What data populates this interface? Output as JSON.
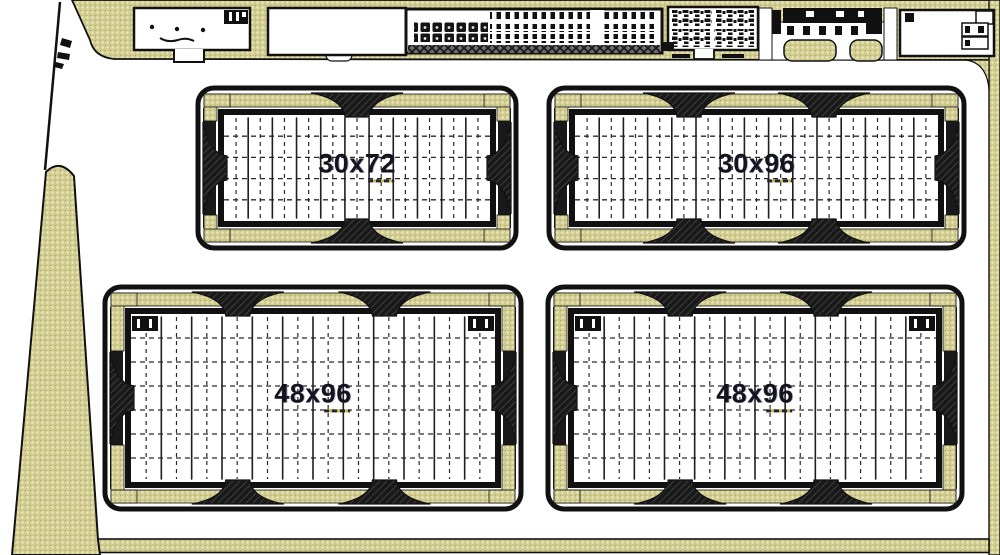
{
  "drawing": {
    "kind": "site-plan",
    "colors": {
      "landscape_khaki": "#cfcb8e",
      "landscape_dot_light": "#eee9bf",
      "landscape_dot_dark": "#a39f66",
      "ink": "#111111",
      "grid_solid": "#1f1f1f",
      "grid_dash": "#2a2a2a",
      "label_text": "#14141f",
      "vent_dark": "#191919",
      "hatch_gray": "#6b6b6b"
    }
  },
  "greenhouses": [
    {
      "label": "30x72",
      "x": 198,
      "y": 88,
      "w": 318,
      "h": 160,
      "cols": 11,
      "rows": 5,
      "vents": [
        0.5
      ],
      "corner_boxes": false
    },
    {
      "label": "30x96",
      "x": 549,
      "y": 88,
      "w": 415,
      "h": 160,
      "cols": 15,
      "rows": 5,
      "vents": [
        0.32,
        0.68
      ],
      "corner_boxes": false
    },
    {
      "label": "48x96",
      "x": 105,
      "y": 287,
      "w": 416,
      "h": 222,
      "cols": 12,
      "rows": 7,
      "vents": [
        0.3,
        0.69
      ],
      "corner_boxes": true
    },
    {
      "label": "48x96",
      "x": 548,
      "y": 287,
      "w": 414,
      "h": 222,
      "cols": 12,
      "rows": 7,
      "vents": [
        0.3,
        0.69
      ],
      "corner_boxes": true
    }
  ]
}
